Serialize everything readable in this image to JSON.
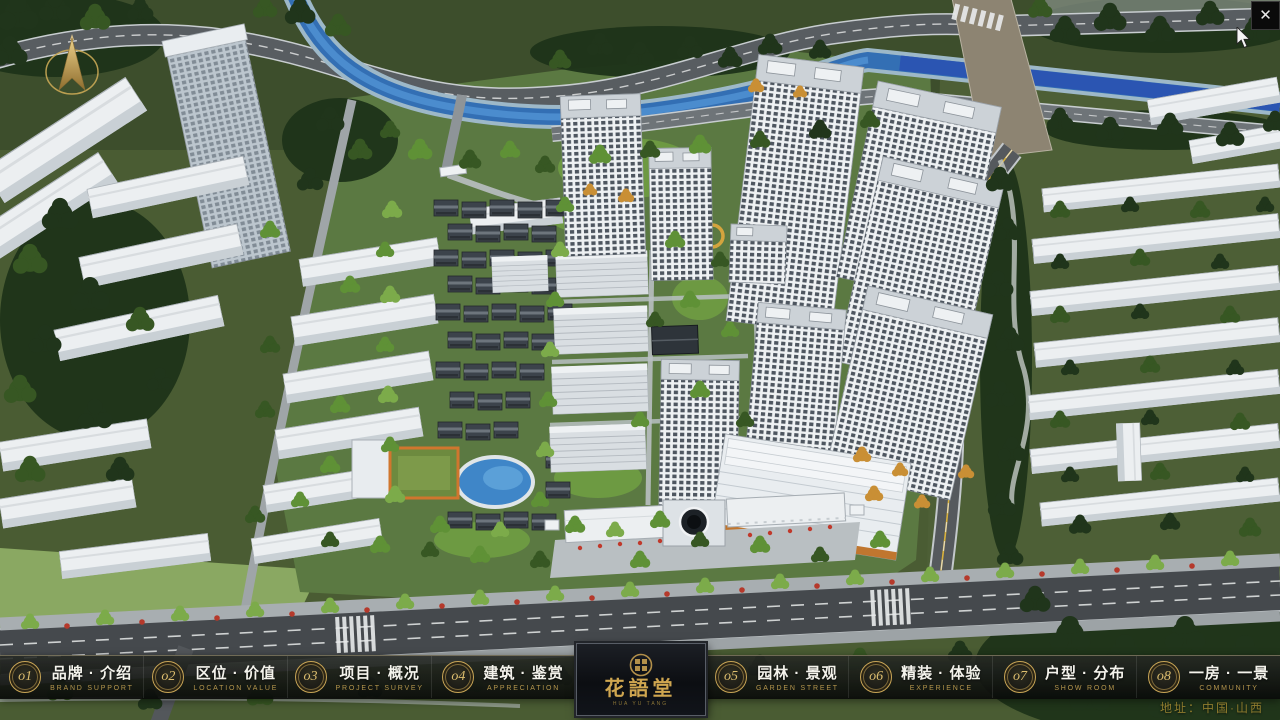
{
  "window": {
    "close": "✕"
  },
  "logo": {
    "name": "花語堂",
    "tagline": "HUA YU TANG"
  },
  "nav": {
    "items": [
      {
        "num": "o1",
        "title": "品牌 · 介绍",
        "subtitle": "BRAND SUPPORT"
      },
      {
        "num": "o2",
        "title": "区位 · 价值",
        "subtitle": "LOCATION VALUE"
      },
      {
        "num": "o3",
        "title": "项目 · 概况",
        "subtitle": "PROJECT SURVEY"
      },
      {
        "num": "o4",
        "title": "建筑 · 鉴赏",
        "subtitle": "APPRECIATION"
      },
      {
        "num": "o5",
        "title": "园林 · 景观",
        "subtitle": "GARDEN STREET"
      },
      {
        "num": "o6",
        "title": "精装 · 体验",
        "subtitle": "EXPERIENCE"
      },
      {
        "num": "o7",
        "title": "户型 · 分布",
        "subtitle": "SHOW ROOM"
      },
      {
        "num": "o8",
        "title": "一房 · 一景",
        "subtitle": "COMMUNITY"
      }
    ]
  },
  "footer": {
    "address": "地址：中国·山西"
  },
  "colors": {
    "accent_gold": "#c9a44f",
    "nav_title": "#f4f3ec",
    "nav_subtitle": "#b5964d",
    "river": "#336fb4",
    "canal_deep": "#2b55b2",
    "address_text": "#8f7c2e",
    "building_white": "#eef1f3",
    "window_dark": "#2b3540"
  }
}
